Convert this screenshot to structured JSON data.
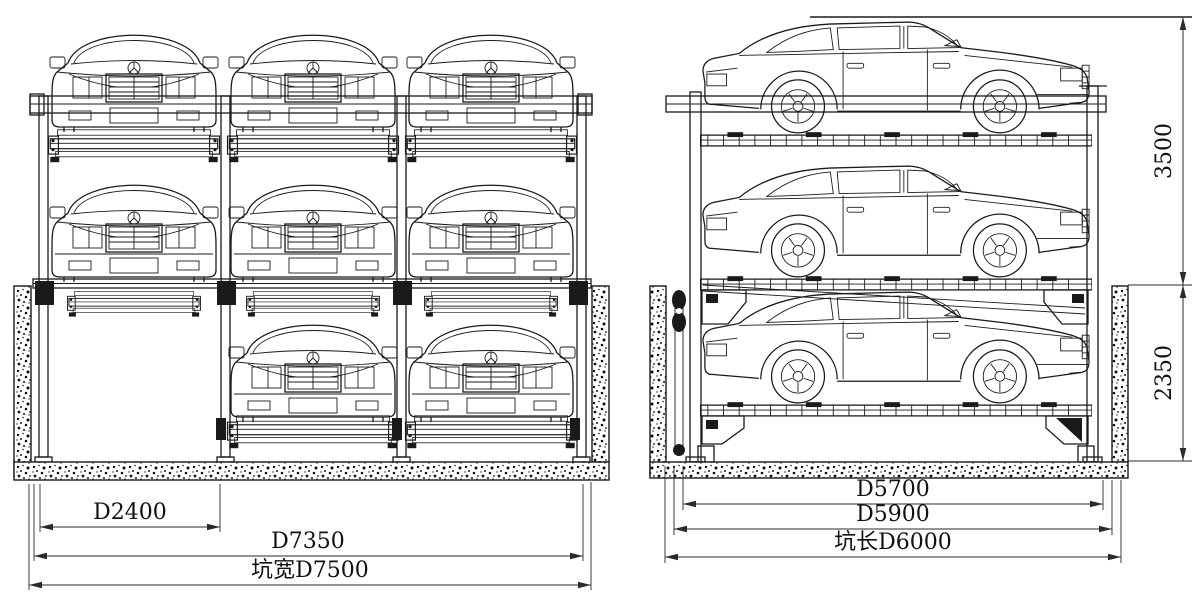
{
  "page": {
    "background_color": "#ffffff",
    "line_color": "#1a1a1a",
    "description_type": "parking-lift-engineering-drawing"
  },
  "front_view": {
    "cars_top_row": 3,
    "cars_middle_row": 3,
    "cars_pit_row": 2,
    "empty_pit_bays": 1,
    "dimensions": {
      "bay_width": "D2400",
      "frame_width": "D7350",
      "pit_width": "坑宽D7500"
    }
  },
  "side_view": {
    "stacked_cars": 3,
    "dimensions": {
      "platform_length": "D5700",
      "frame_length": "D5900",
      "pit_length": "坑长D6000",
      "height_above_ground": "3500",
      "pit_depth": "2350"
    }
  }
}
